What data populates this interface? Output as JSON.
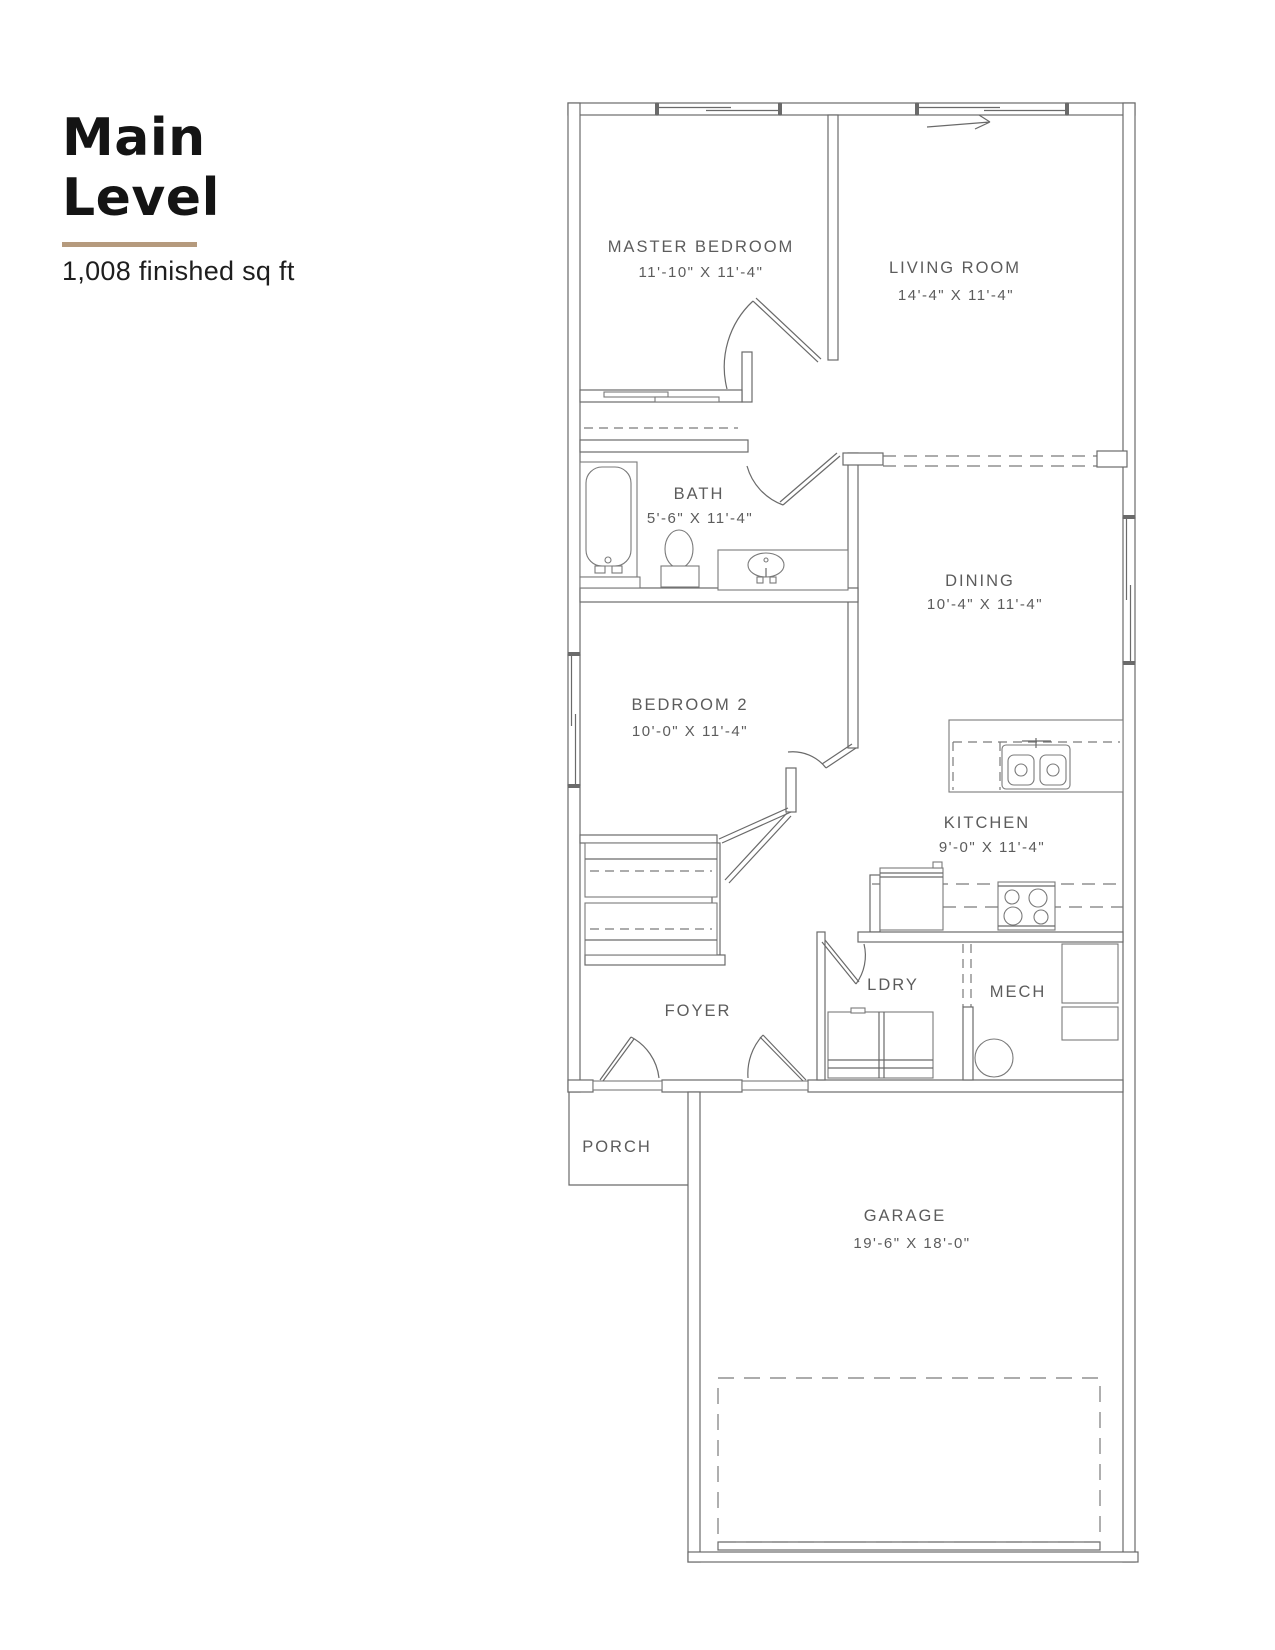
{
  "header": {
    "title_line1": "Main",
    "title_line2": "Level",
    "subtitle": "1,008 finished sq ft",
    "accent_color": "#b59a7d"
  },
  "plan": {
    "line_color": "#6a6a6a",
    "text_color": "#5c5c5c",
    "rooms": {
      "master_bedroom": {
        "name": "MASTER BEDROOM",
        "dims": "11'-10\" X 11'-4\""
      },
      "living_room": {
        "name": "LIVING ROOM",
        "dims": "14'-4\" X 11'-4\""
      },
      "bath": {
        "name": "BATH",
        "dims": "5'-6\" X 11'-4\""
      },
      "dining": {
        "name": "DINING",
        "dims": "10'-4\" X 11'-4\""
      },
      "bedroom_2": {
        "name": "BEDROOM 2",
        "dims": "10'-0\" X 11'-4\""
      },
      "kitchen": {
        "name": "KITCHEN",
        "dims": "9'-0\" X 11'-4\""
      },
      "laundry": {
        "name": "LDRY"
      },
      "mech": {
        "name": "MECH"
      },
      "foyer": {
        "name": "FOYER"
      },
      "porch": {
        "name": "PORCH"
      },
      "garage": {
        "name": "GARAGE",
        "dims": "19'-6\" X 18'-0\""
      }
    }
  }
}
